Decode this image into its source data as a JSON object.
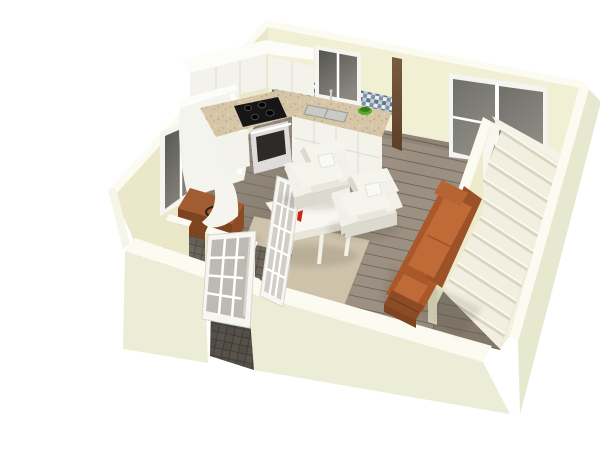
{
  "meta": {
    "title": "3D cutaway floor plan rendering of a studio apartment, viewed from above the front-left corner on a white background",
    "image_width": 600,
    "image_height": 423
  },
  "palette": {
    "background": "#ffffff",
    "wall_top": "#fbfbf1",
    "wall_interior": "#f1efd4",
    "wall_interior_shaded": "#ebe8ca",
    "wall_exterior": "#ecedd7",
    "floor_wood": "#8f8477",
    "floor_wood_light": "#9a8e80",
    "floor_wood_dark": "#6f655a",
    "entry_tile": "#6d675d",
    "rug": "#cec2ab",
    "counter_granite": "#d6c5a6",
    "cabinet_white": "#f3f3ec",
    "backsplash_mosaic": "#8ca3b4",
    "window_glass": "#55544e",
    "sliding_door_glass": "#706f69",
    "stairs_tread": "#f2efe1",
    "stairs_riser": "#d8d5c1",
    "sofa_white": "#f1f0e9",
    "sofa_orange": "#aa572a",
    "wood_furniture": "#a25c31",
    "wall_column_wood": "#6b4a2f",
    "stove_black": "#161616",
    "oven_steel": "#dedddb",
    "accent_red": "#c62310",
    "plant_green": "#55ad2b"
  },
  "scene": {
    "type": "3d-floor-plan-render",
    "camera": "elevated three-quarter view from the front-left; white background",
    "rooms": [
      {
        "name": "kitchen",
        "position": "back-left",
        "features": [
          "L-shaped white cabinets",
          "beige granite countertop",
          "black cooktop with stainless oven",
          "double sink under window",
          "blue-gray mosaic backsplash",
          "tall white refrigerator cabinet",
          "green fruit bowl",
          "dark wood wall column"
        ]
      },
      {
        "name": "living-dining",
        "position": "center",
        "features": [
          "two white boxy armchairs with pillows",
          "white ornate dining table with red bottles and flowers",
          "beige area rug",
          "orange sectional sofa with wooden base",
          "glass-paned folding divider"
        ]
      },
      {
        "name": "entry",
        "position": "front-left",
        "features": [
          "open white french door with glass grid",
          "interior partition wall",
          "dark gray tile floor",
          "wooden console with curved white sculpture and dark ring"
        ]
      },
      {
        "name": "staircase",
        "position": "right",
        "features": [
          "straight staircase rising along right wall",
          "cream half-wall stair enclosure"
        ]
      }
    ],
    "openings": [
      {
        "name": "kitchen-window",
        "wall": "back",
        "glazing": "dark glass, white frame, center mullion"
      },
      {
        "name": "sliding-glass-door",
        "wall": "back-right",
        "glazing": "two dark panels, white frame"
      },
      {
        "name": "side-window",
        "wall": "left",
        "glazing": "dark glass, white frame, center mullion"
      },
      {
        "name": "front-door-opening",
        "wall": "front",
        "door": "white french door swung open inward"
      }
    ]
  }
}
